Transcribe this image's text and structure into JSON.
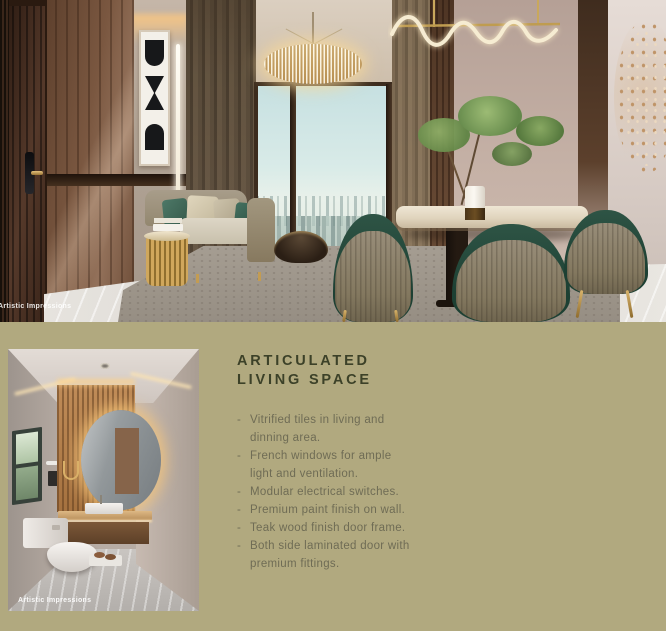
{
  "page": {
    "background_color": "#b1a97f"
  },
  "hero": {
    "credit": "Artistic Impressions"
  },
  "bathroom": {
    "credit": "Artistic Impressions"
  },
  "section": {
    "title_line1": "ARTICULATED",
    "title_line2": "LIVING SPACE",
    "title_color": "#3c4128",
    "text_color": "#6f6c55",
    "bullet_marker": "-",
    "bullets": [
      [
        "Vitrified tiles in living and",
        "dinning area."
      ],
      [
        "French windows for ample",
        "light and ventilation."
      ],
      [
        "Modular electrical switches."
      ],
      [
        "Premium paint finish on wall."
      ],
      [
        "Teak wood finish door frame."
      ],
      [
        "Both side laminated door with",
        "premium fittings."
      ]
    ]
  }
}
